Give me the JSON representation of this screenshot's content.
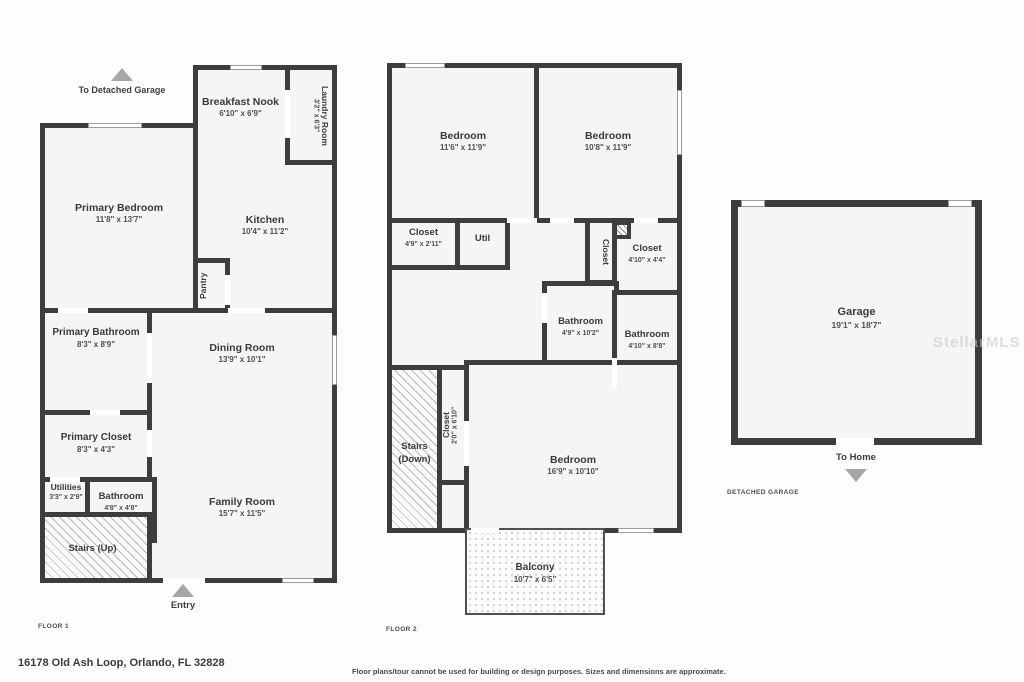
{
  "f1": {
    "label": "FLOOR 1",
    "to_garage_label": "To Detached Garage",
    "entry_label": "Entry",
    "rooms": {
      "primary_bedroom": {
        "name": "Primary Bedroom",
        "dims": "11'8\" x 13'7\""
      },
      "breakfast_nook": {
        "name": "Breakfast Nook",
        "dims": "6'10\" x 6'9\""
      },
      "laundry": {
        "name": "Laundry Room",
        "dims": "3'2\" x 6'3\""
      },
      "kitchen": {
        "name": "Kitchen",
        "dims": "10'4\" x 11'2\""
      },
      "pantry": {
        "name": "Pantry"
      },
      "primary_bathroom": {
        "name": "Primary Bathroom",
        "dims": "8'3\" x 8'9\""
      },
      "dining_room": {
        "name": "Dining Room",
        "dims": "13'9\" x 10'1\""
      },
      "primary_closet": {
        "name": "Primary Closet",
        "dims": "8'3\" x 4'3\""
      },
      "utilities": {
        "name": "Utilities",
        "dims": "3'3\" x 2'9\""
      },
      "bathroom": {
        "name": "Bathroom",
        "dims": "4'8\" x 4'8\""
      },
      "family_room": {
        "name": "Family Room",
        "dims": "15'7\" x 11'5\""
      },
      "stairs": {
        "name": "Stairs (Up)"
      }
    }
  },
  "f2": {
    "label": "FLOOR 2",
    "rooms": {
      "bedroom_left": {
        "name": "Bedroom",
        "dims": "11'6\" x 11'9\""
      },
      "bedroom_right": {
        "name": "Bedroom",
        "dims": "10'8\" x 11'9\""
      },
      "closet_a": {
        "name": "Closet",
        "dims": "4'9\" x 2'11\""
      },
      "util": {
        "name": "Util"
      },
      "closet_b": {
        "name": "Closet"
      },
      "closet_c": {
        "name": "Closet",
        "dims": "4'10\" x 4'4\""
      },
      "bathroom_a": {
        "name": "Bathroom",
        "dims": "4'9\" x 10'2\""
      },
      "bathroom_b": {
        "name": "Bathroom",
        "dims": "4'10\" x 8'8\""
      },
      "stairs": {
        "name": "Stairs (Down)"
      },
      "closet_d": {
        "name": "Closet",
        "dims": "2'0\" x 6'10\""
      },
      "bedroom_big": {
        "name": "Bedroom",
        "dims": "16'9\" x 10'10\""
      },
      "balcony": {
        "name": "Balcony",
        "dims": "10'7\" x 6'5\""
      }
    }
  },
  "garage": {
    "label": "DETACHED GARAGE",
    "to_home_label": "To Home",
    "rooms": {
      "garage": {
        "name": "Garage",
        "dims": "19'1\" x 18'7\""
      }
    }
  },
  "footer": {
    "address": "16178 Old Ash Loop, Orlando, FL 32828",
    "disclaimer": "Floor plans/tour cannot be used for building or design purposes. Sizes and dimensions are approximate."
  },
  "watermark": "StellarMLS"
}
